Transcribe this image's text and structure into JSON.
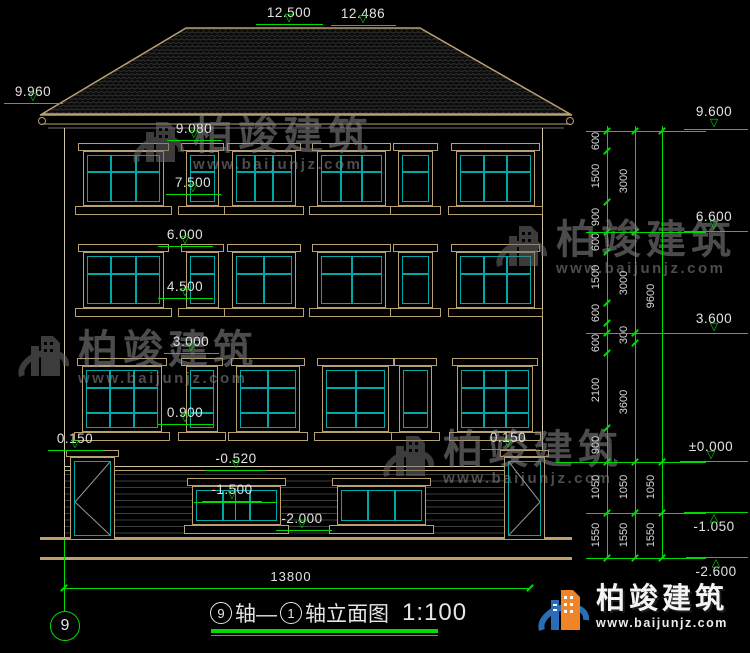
{
  "drawing": {
    "type": "building-elevation",
    "palette": {
      "line_tan": "#BDA06C",
      "glazing_cyan": "#00A9A9",
      "dimension_green": "#00DB00",
      "text_white": "#E2E2E2"
    },
    "elevation_markers": [
      {
        "label": "12.500",
        "cx": 289,
        "textY": 5,
        "lineY": 24,
        "x1": 256,
        "x2": 323
      },
      {
        "label": "12.486",
        "cx": 363,
        "textY": 6,
        "lineY": 25,
        "x1": 331,
        "x2": 396
      },
      {
        "label": "9.960",
        "cx": 33,
        "textY": 84,
        "lineY": 103,
        "x1": 4,
        "x2": 63
      },
      {
        "label": "9.080",
        "cx": 194,
        "textY": 121,
        "lineY": 140,
        "x1": 167,
        "x2": 222
      },
      {
        "label": "7.500",
        "cx": 193,
        "textY": 175,
        "lineY": 194,
        "x1": 166,
        "x2": 221
      },
      {
        "label": "6.000",
        "cx": 185,
        "textY": 227,
        "lineY": 246,
        "x1": 158,
        "x2": 213
      },
      {
        "label": "4.500",
        "cx": 185,
        "textY": 279,
        "lineY": 298,
        "x1": 158,
        "x2": 213
      },
      {
        "label": "3.000",
        "cx": 191,
        "textY": 334,
        "lineY": 353,
        "x1": 164,
        "x2": 219
      },
      {
        "label": "0.900",
        "cx": 185,
        "textY": 405,
        "lineY": 424,
        "x1": 158,
        "x2": 213
      },
      {
        "label": "0.150",
        "cx": 75,
        "textY": 431,
        "lineY": 450,
        "x1": 48,
        "x2": 103
      },
      {
        "label": "0.150",
        "cx": 508,
        "textY": 430,
        "lineY": 449,
        "x1": 481,
        "x2": 536
      },
      {
        "label": "-0.520",
        "cx": 236,
        "textY": 451,
        "lineY": 470,
        "x1": 206,
        "x2": 266
      },
      {
        "label": "-1.500",
        "cx": 232,
        "textY": 482,
        "lineY": 501,
        "x1": 202,
        "x2": 262
      },
      {
        "label": "-2.000",
        "cx": 302,
        "textY": 511,
        "lineY": 530,
        "x1": 276,
        "x2": 332
      },
      {
        "label": "9.600",
        "cx": 714,
        "textY": 104,
        "lineY": 129,
        "x1": 684,
        "x2": 748
      },
      {
        "label": "6.600",
        "cx": 714,
        "textY": 209,
        "lineY": 231,
        "x1": 684,
        "x2": 748
      },
      {
        "label": "3.600",
        "cx": 714,
        "textY": 311,
        "lineY": 333,
        "x1": 684,
        "x2": 748
      },
      {
        "label": "±0.000",
        "cx": 711,
        "textY": 439,
        "lineY": 461,
        "x1": 680,
        "x2": 748
      },
      {
        "label": "-1.050",
        "cx": 714,
        "textY": 519,
        "lineY": 512,
        "x1": 684,
        "x2": 748,
        "tri": "up"
      },
      {
        "label": "-2.600",
        "cx": 716,
        "textY": 564,
        "lineY": 557,
        "x1": 686,
        "x2": 748,
        "tri": "up"
      }
    ],
    "dim_chains": [
      {
        "x": 607,
        "top": 126,
        "bottom": 558,
        "ticks": [
          131,
          151,
          202,
          232,
          252,
          303,
          323,
          333,
          353,
          428,
          462,
          513,
          558
        ],
        "labels": [
          {
            "t": "600",
            "y": 141
          },
          {
            "t": "1500",
            "y": 176
          },
          {
            "t": "900",
            "y": 217
          },
          {
            "t": "600",
            "y": 242
          },
          {
            "t": "1500",
            "y": 277
          },
          {
            "t": "600",
            "y": 313
          },
          {
            "t": "600",
            "y": 343
          },
          {
            "t": "2100",
            "y": 390
          },
          {
            "t": "900",
            "y": 445
          },
          {
            "t": "1050",
            "y": 487
          },
          {
            "t": "1550",
            "y": 535
          }
        ]
      },
      {
        "x": 635,
        "top": 126,
        "bottom": 558,
        "ticks": [
          131,
          232,
          333,
          343,
          462,
          513,
          558
        ],
        "labels": [
          {
            "t": "3000",
            "y": 181
          },
          {
            "t": "3000",
            "y": 283
          },
          {
            "t": "300",
            "y": 335
          },
          {
            "t": "3600",
            "y": 402
          },
          {
            "t": "1050",
            "y": 487
          },
          {
            "t": "1550",
            "y": 535
          }
        ]
      },
      {
        "x": 662,
        "top": 126,
        "bottom": 558,
        "ticks": [
          131,
          462,
          513,
          558
        ],
        "labels": [
          {
            "t": "9600",
            "y": 296
          },
          {
            "t": "1050",
            "y": 487
          },
          {
            "t": "1550",
            "y": 535
          }
        ]
      }
    ],
    "dim_rules": [
      {
        "y": 131,
        "x1": 586,
        "x2": 706
      },
      {
        "y": 232,
        "x1": 586,
        "x2": 706
      },
      {
        "y": 333,
        "x1": 586,
        "x2": 706
      },
      {
        "y": 462,
        "x1": 556,
        "x2": 706
      },
      {
        "y": 513,
        "x1": 586,
        "x2": 706
      },
      {
        "y": 558,
        "x1": 586,
        "x2": 706
      }
    ],
    "inner_dims": {
      "basement_window_hline_label": "-1.500",
      "hline": {
        "y": 502,
        "x1": 194,
        "x2": 277
      },
      "vline": {
        "x": 235,
        "y1": 488,
        "y2": 521
      }
    },
    "overall_width": {
      "label": "13800",
      "lineY": 588,
      "x1": 64,
      "x2": 530,
      "textCx": 291,
      "textY": 569
    },
    "axis_bubble": {
      "label": "9"
    },
    "title": {
      "axis_from": "9",
      "seg1": "轴—",
      "axis_to": "1",
      "seg2": "轴立面图",
      "scale": "1:100"
    },
    "brand": {
      "name": "柏竣建筑",
      "url": "www.baijunjz.com"
    },
    "watermark": {
      "name": "柏竣建筑",
      "url": "www.baijunjz.com",
      "positions": [
        {
          "x": 133,
          "y": 116
        },
        {
          "x": 496,
          "y": 220
        },
        {
          "x": 18,
          "y": 330
        },
        {
          "x": 383,
          "y": 430
        }
      ]
    }
  }
}
